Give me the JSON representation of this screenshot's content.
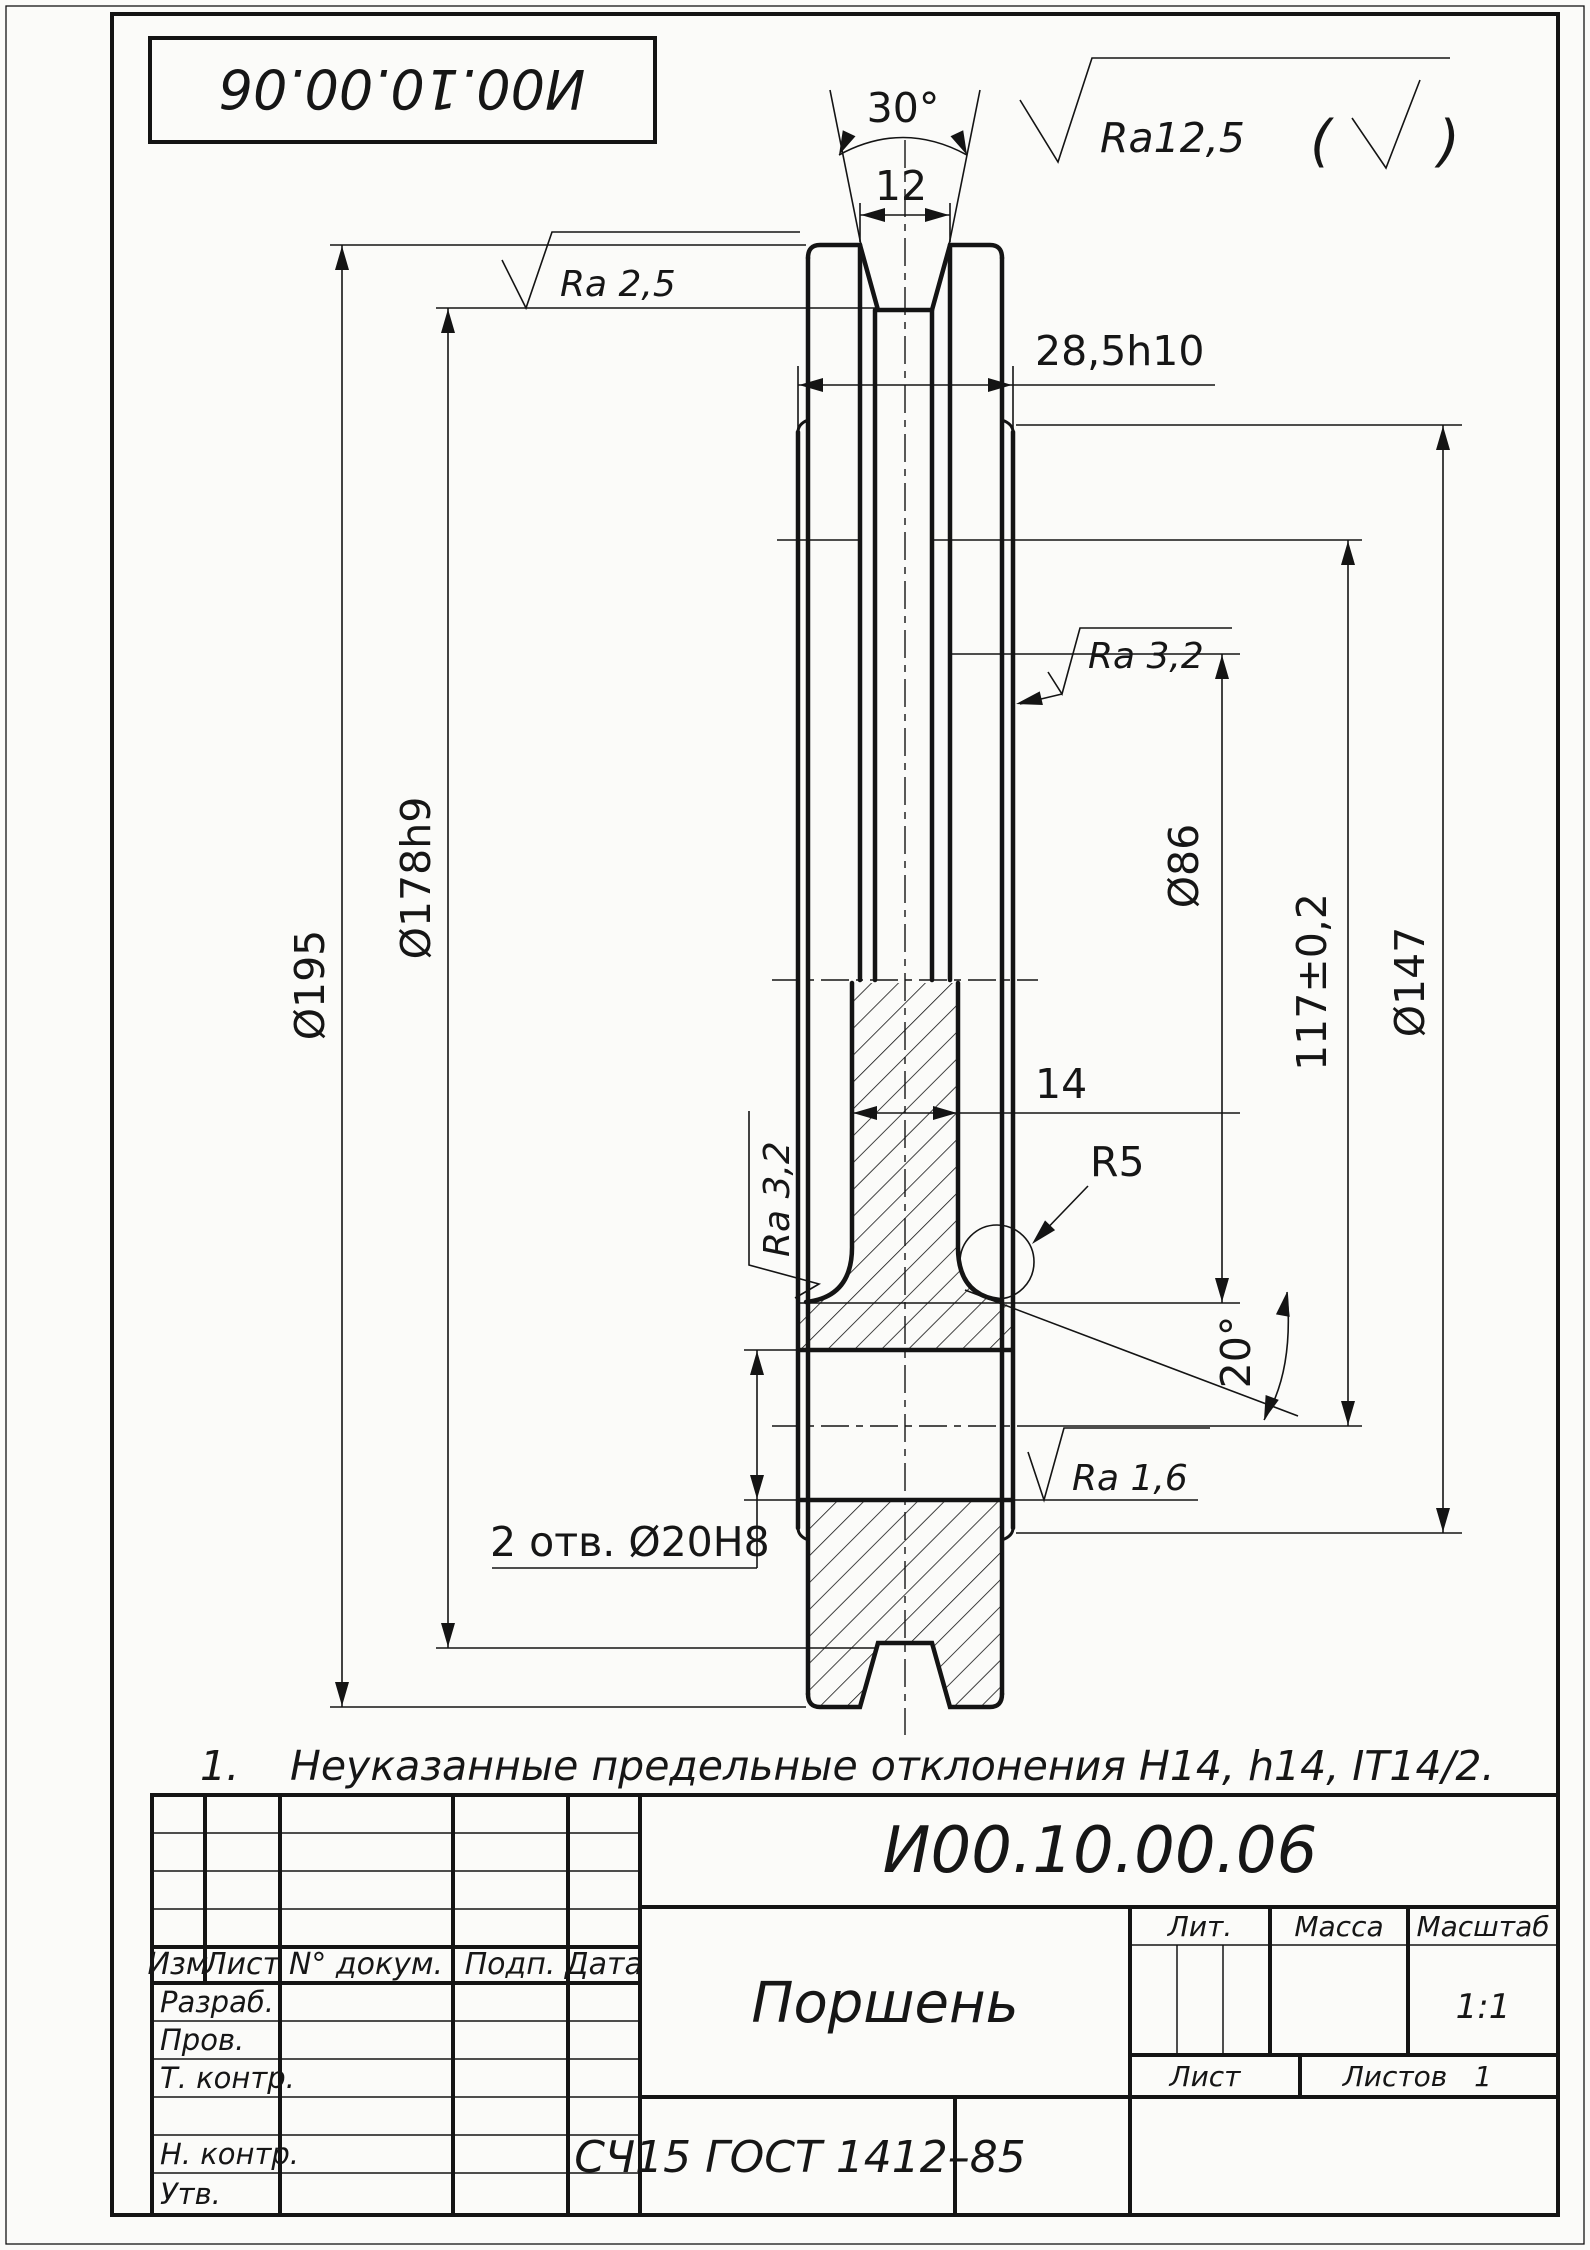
{
  "sheet": {
    "stamp_top": "И00.10.00.06",
    "roughness_general_value": "Ra12,5",
    "paren_open": "(",
    "paren_close": ")",
    "note_number": "1.",
    "note_text": "Неуказанные  предельные  отклонения  H14,  h14,  IT14/2."
  },
  "dimensions": {
    "angle_top": "30°",
    "width_top": "12",
    "hub_width": "28,5h10",
    "d195": "Ø195",
    "d178": "Ø178h9",
    "d86": "Ø86",
    "len117": "117±0,2",
    "d147": "Ø147",
    "wall14": "14",
    "r5": "R5",
    "angle20": "20°",
    "holes": "2 отв. Ø20H8"
  },
  "roughness": {
    "ra25": "Ra 2,5",
    "ra32_right": "Ra 3,2",
    "ra32_left": "Ra 3,2",
    "ra16": "Ra 1,6"
  },
  "title_block": {
    "doc_number": "И00.10.00.06",
    "part_name": "Поршень",
    "material": "СЧ15  ГОСТ 1412–85",
    "scale_value": "1:1",
    "sheets_value": "1",
    "headers": {
      "izm": "Изм",
      "list": "Лист",
      "doc": "N°  докум.",
      "podp": "Подп.",
      "data": "Дата",
      "lit": "Лит.",
      "massa": "Масса",
      "masshtab": "Масштаб",
      "list2": "Лист",
      "listov": "Листов"
    },
    "rows": {
      "razrab": "Разраб.",
      "prov": "Пров.",
      "tkontr": "Т. контр.",
      "nkontr": "Н. контр.",
      "utv": "Утв."
    }
  }
}
